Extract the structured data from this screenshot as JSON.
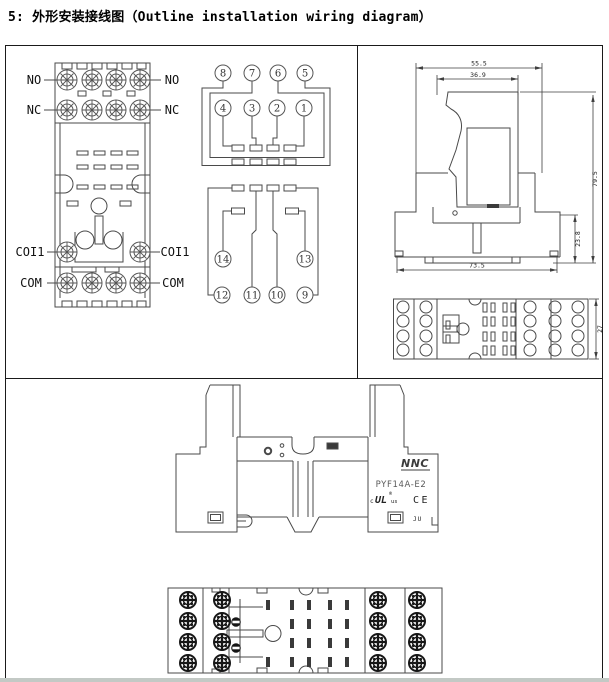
{
  "title": "5: 外形安装接线图（Outline installation wiring diagram）",
  "socket_view": {
    "left": {
      "no": "NO",
      "nc": "NC",
      "coil": "COI1",
      "com": "COM"
    },
    "right": {
      "no": "NO",
      "nc": "NC",
      "coil": "COI1",
      "com": "COM"
    }
  },
  "schematic": {
    "pins": {
      "p1": "1",
      "p2": "2",
      "p3": "3",
      "p4": "4",
      "p5": "5",
      "p6": "6",
      "p7": "7",
      "p8": "8",
      "p9": "9",
      "p10": "10",
      "p11": "11",
      "p12": "12",
      "p13": "13",
      "p14": "14"
    }
  },
  "dimensions": {
    "overall_width": "55.5",
    "relay_width": "36.9",
    "overall_height": "79.5",
    "socket_height": "23.8",
    "base_width": "73.5",
    "socket_depth": "27"
  },
  "product": {
    "brand": "NNC",
    "model": "PYF14A-E2",
    "ul_c": "c",
    "ul": "UL",
    "ul_reg": "®",
    "ul_us": "us",
    "ce": "CE",
    "ju": "JU"
  }
}
